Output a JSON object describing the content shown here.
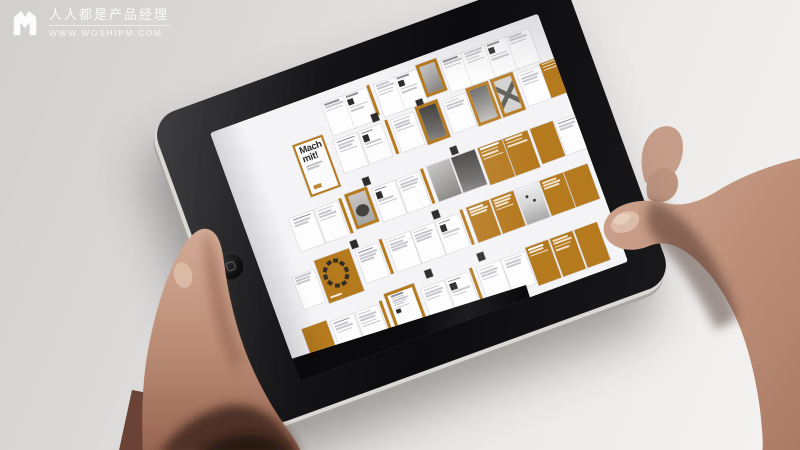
{
  "palette": {
    "background": "#e3e1df",
    "bezel_black": "#131315",
    "accent_orange": "#b5791e",
    "document_white": "#f4f3f6",
    "skin_tone": "#c59a85"
  },
  "watermark": {
    "logo": "M",
    "title": "人人都是产品经理",
    "url": "WWW.WOSHIPM.COM"
  },
  "tablet": {
    "type": "tablet-landscape",
    "home_button": "home"
  },
  "screen": {
    "app": "magazine-layout-overview",
    "cover_title": "Mach mit!",
    "pages": [
      {
        "x": 33,
        "y": 4,
        "kind": "text",
        "head": 1,
        "lines": 3
      },
      {
        "x": 39.5,
        "y": 4,
        "kind": "thumbs"
      },
      {
        "x": 46.8,
        "y": 3.5,
        "kind": "divider",
        "w": 0.9,
        "h": 12
      },
      {
        "x": 48.6,
        "y": 4,
        "kind": "text",
        "lines": 4
      },
      {
        "x": 55,
        "y": 4,
        "kind": "thumbs"
      },
      {
        "x": 61.8,
        "y": 2.5,
        "w": 6.4,
        "h": 13,
        "kind": "photo-frame",
        "pattern": "soft"
      },
      {
        "x": 69,
        "y": 4,
        "kind": "text",
        "head": 1,
        "lines": 3
      },
      {
        "x": 75.5,
        "y": 4,
        "kind": "text",
        "lines": 4
      },
      {
        "x": 82.5,
        "y": 4,
        "kind": "thumbs"
      },
      {
        "x": 89,
        "y": 4,
        "kind": "text",
        "lines": 3
      },
      {
        "x": 45,
        "y": 14.5,
        "kind": "chip"
      },
      {
        "x": 58.5,
        "y": 15,
        "kind": "chip"
      },
      {
        "x": 21,
        "y": 15,
        "w": 9,
        "h": 21,
        "kind": "cover"
      },
      {
        "x": 32.5,
        "y": 19,
        "kind": "text",
        "head": 1,
        "lines": 4
      },
      {
        "x": 40,
        "y": 19,
        "kind": "thumbs"
      },
      {
        "x": 48,
        "y": 18,
        "kind": "divider"
      },
      {
        "x": 49.8,
        "y": 19,
        "kind": "text",
        "lines": 4
      },
      {
        "x": 57.5,
        "y": 17.5,
        "w": 7,
        "h": 15,
        "kind": "photo-frame",
        "pattern": "dark"
      },
      {
        "x": 65.5,
        "y": 19,
        "kind": "text",
        "lines": 3
      },
      {
        "x": 73,
        "y": 17.5,
        "w": 7,
        "h": 15,
        "kind": "photo-frame",
        "pattern": "wall"
      },
      {
        "x": 80.5,
        "y": 17.5,
        "w": 7,
        "h": 15,
        "kind": "photo-frame",
        "pattern": "x"
      },
      {
        "x": 88.5,
        "y": 19,
        "kind": "text",
        "lines": 4
      },
      {
        "x": 95.5,
        "y": 18,
        "w": 6,
        "h": 14,
        "kind": "orange-text",
        "lines": 3
      },
      {
        "x": 36.5,
        "y": 36,
        "kind": "chip"
      },
      {
        "x": 63,
        "y": 36.5,
        "kind": "chip"
      },
      {
        "x": 13,
        "y": 41,
        "kind": "text",
        "head": 1,
        "lines": 3
      },
      {
        "x": 20.5,
        "y": 41,
        "kind": "text",
        "lines": 4
      },
      {
        "x": 28,
        "y": 40,
        "kind": "divider"
      },
      {
        "x": 30,
        "y": 39.5,
        "w": 7,
        "h": 14,
        "kind": "photo-frame",
        "pattern": "car"
      },
      {
        "x": 38,
        "y": 41,
        "kind": "thumbs"
      },
      {
        "x": 45.5,
        "y": 41,
        "kind": "text",
        "lines": 4
      },
      {
        "x": 53,
        "y": 40,
        "kind": "divider"
      },
      {
        "x": 55,
        "y": 40,
        "w": 7,
        "h": 14,
        "kind": "photo",
        "pattern": "soft"
      },
      {
        "x": 62.5,
        "y": 40,
        "w": 7,
        "h": 14,
        "kind": "photo",
        "pattern": "dark"
      },
      {
        "x": 70.5,
        "y": 40,
        "w": 7.5,
        "h": 15,
        "kind": "orange-text",
        "head": 1,
        "lines": 4
      },
      {
        "x": 78.2,
        "y": 40,
        "w": 7.5,
        "h": 15,
        "kind": "orange-text",
        "lines": 3
      },
      {
        "x": 86.5,
        "y": 40,
        "w": 7,
        "h": 14,
        "kind": "orange"
      },
      {
        "x": 94,
        "y": 41,
        "kind": "text",
        "head": 1,
        "lines": 3
      },
      {
        "x": 27,
        "y": 57,
        "kind": "chip"
      },
      {
        "x": 52,
        "y": 57,
        "kind": "chip"
      },
      {
        "x": 8,
        "y": 62,
        "w": 6.5,
        "h": 13,
        "kind": "text",
        "lines": 3
      },
      {
        "x": 15.5,
        "y": 59,
        "w": 10.5,
        "h": 17,
        "kind": "wreath"
      },
      {
        "x": 27.5,
        "y": 61,
        "kind": "text",
        "head": 1,
        "lines": 4
      },
      {
        "x": 35,
        "y": 60,
        "kind": "divider"
      },
      {
        "x": 37,
        "y": 61,
        "kind": "text",
        "lines": 4
      },
      {
        "x": 44.5,
        "y": 61,
        "kind": "text",
        "lines": 4
      },
      {
        "x": 52,
        "y": 61,
        "kind": "thumbs"
      },
      {
        "x": 59.5,
        "y": 60,
        "kind": "divider"
      },
      {
        "x": 61.5,
        "y": 60,
        "w": 7,
        "h": 14,
        "kind": "orange-text",
        "head": 1,
        "lines": 3
      },
      {
        "x": 69,
        "y": 60,
        "w": 7,
        "h": 14,
        "kind": "orange-text",
        "lines": 4
      },
      {
        "x": 76.5,
        "y": 60,
        "w": 7,
        "h": 14,
        "kind": "gradient"
      },
      {
        "x": 84,
        "y": 60,
        "w": 7,
        "h": 14,
        "kind": "orange-text",
        "lines": 3
      },
      {
        "x": 91.5,
        "y": 60,
        "w": 7,
        "h": 14,
        "kind": "orange"
      },
      {
        "x": 44,
        "y": 77,
        "kind": "chip"
      },
      {
        "x": 60,
        "y": 77.5,
        "kind": "chip"
      },
      {
        "x": 5.5,
        "y": 82,
        "w": 7.5,
        "h": 15,
        "kind": "orange"
      },
      {
        "x": 14,
        "y": 83,
        "kind": "text",
        "head": 1,
        "lines": 4
      },
      {
        "x": 21.5,
        "y": 83,
        "kind": "text",
        "lines": 5
      },
      {
        "x": 29,
        "y": 82,
        "kind": "divider"
      },
      {
        "x": 31,
        "y": 80,
        "w": 9,
        "h": 19,
        "kind": "infographic"
      },
      {
        "x": 41.5,
        "y": 83,
        "kind": "text",
        "lines": 4
      },
      {
        "x": 49,
        "y": 83,
        "kind": "thumbs"
      },
      {
        "x": 56.5,
        "y": 82,
        "kind": "divider"
      },
      {
        "x": 58.5,
        "y": 83,
        "kind": "text",
        "lines": 4
      },
      {
        "x": 66,
        "y": 83,
        "kind": "text",
        "lines": 3
      },
      {
        "x": 73.5,
        "y": 82,
        "w": 7,
        "h": 15,
        "kind": "orange-text",
        "head": 1,
        "lines": 3
      },
      {
        "x": 81,
        "y": 82,
        "w": 7,
        "h": 15,
        "kind": "orange-text",
        "lines": 4
      },
      {
        "x": 88.5,
        "y": 82,
        "w": 7,
        "h": 15,
        "kind": "orange"
      }
    ]
  }
}
